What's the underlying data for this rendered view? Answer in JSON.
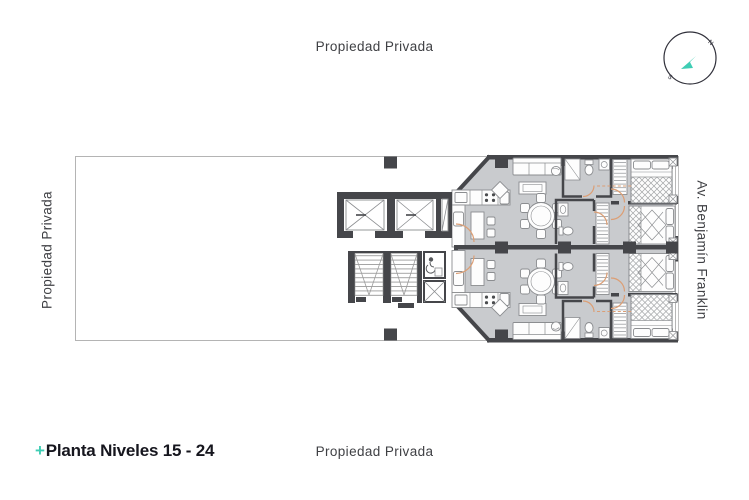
{
  "labels": {
    "top": "Propiedad Privada",
    "left": "Propiedad Privada",
    "right": "Av. Benjamín Franklin",
    "bottom": "Propiedad Privada"
  },
  "title": {
    "prefix": "+",
    "text": "Planta Niveles 15 - 24"
  },
  "compass": {
    "north": "N",
    "south": "S"
  },
  "colors": {
    "accent_teal": "#3FCDB4",
    "title_text": "#16161E",
    "label_text": "#3F4044",
    "wall": "#45464A",
    "floor": "#C9CBCE",
    "door_swing": "#DC9E74",
    "property_line": "#B4B4B4",
    "furniture_stroke": "#8B8D90"
  },
  "plan": {
    "name": "Planta Niveles 15 - 24",
    "components": [
      "property-boundary",
      "structural-columns",
      "elevator",
      "elevator",
      "service-shaft",
      "stairs",
      "accessible-wc",
      "upper-apartment",
      "lower-apartment",
      "kitchen",
      "breakfast-bar",
      "refrigerator",
      "stove",
      "sink",
      "sofa",
      "coffee-table",
      "armchair",
      "ceiling-fan",
      "dining-table-6-chairs",
      "bathroom",
      "shower",
      "toilet",
      "washbasin",
      "wardrobe",
      "double-bed",
      "nightstand",
      "door-swings",
      "windows"
    ]
  }
}
